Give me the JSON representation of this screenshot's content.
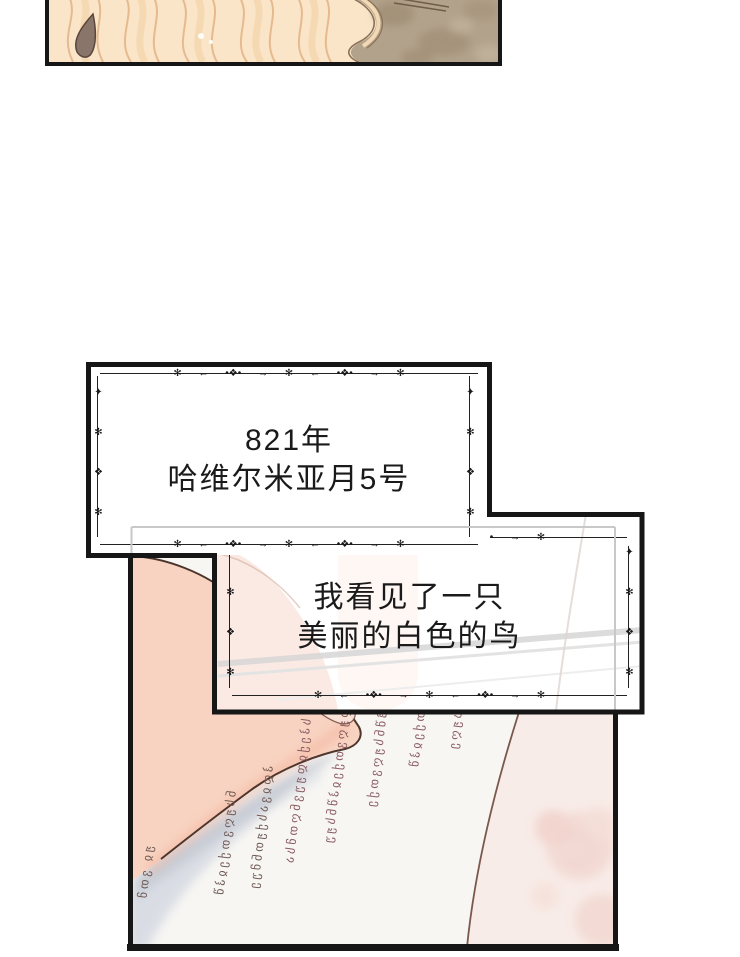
{
  "comic": {
    "caption_date": {
      "line1": "821年",
      "line2": "哈维尔米亚月5号"
    },
    "caption_bird": {
      "line1": "我看见了一只",
      "line2": "美丽的白色的鸟"
    }
  },
  "ornament": {
    "horizontal_pattern": "✻ ← •❖• → ✻ ← •❖• → ✻",
    "vertical_pattern": "✦ ✻ ❖ ✻ ✦ ✻ ❖ ✻ ✦"
  },
  "script": {
    "columns": [
      "ჟჲ ვთმ",
      "ნსჟღვთქეჲჰშ",
      "ჰდჲვასქჟთნმუე",
      "სჰექჲდჟუვნღთმსა",
      "დჟღვთქეჲჰშნსჟუ",
      "ჲჰშნსჟღვთქე",
      "ვთქეჲჰშ",
      "ნსჟღე"
    ]
  },
  "palette": {
    "panel_border": "#161616",
    "ghost_line": "#c8c8c8",
    "hair": "#fae5c9",
    "hair_stroke": "#e3b386",
    "backdrop_taupe": "#b3a28b",
    "skin": "#f8d3c1",
    "skin_outline": "#4e352b",
    "page_shadow": "#c9cdd6",
    "script_ink": "#8a5a60",
    "pink_page": "#f8ece8",
    "text": "#1a1a1a"
  }
}
